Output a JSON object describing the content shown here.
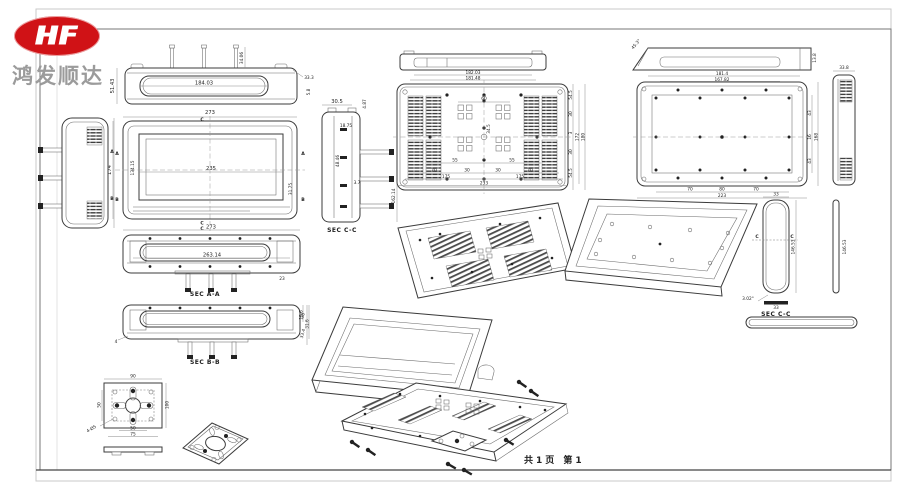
{
  "page": {
    "footer": "共1页 第1"
  },
  "logo": {
    "monogram": "HF",
    "company": "鸿发顺达",
    "oval_color": "#d01216",
    "company_color": "#9b9b9b"
  },
  "sections": {
    "aa": "SEC A-A",
    "bb": "SEC B-B",
    "cc": "SEC C-C",
    "cc_right": "SEC C-C"
  },
  "markers": {
    "a": "A",
    "b": "B",
    "c": "C"
  },
  "dims": {
    "top_view": {
      "slot": "184.03",
      "height": "51.43",
      "pin": "34.06",
      "corner": "33.3",
      "edge": "5.8"
    },
    "front_view": {
      "width": "273",
      "screen_w": "235",
      "screen_h": "134.15",
      "height": "174",
      "bezel": "31.75"
    },
    "sec_cc": {
      "depth": "30.5",
      "lip": "4.87",
      "offset": "18.75",
      "mid": "48.46",
      "rib": "3.7",
      "height": "162.14"
    },
    "rear_profile": {
      "w1": "182.03",
      "w2": "181.48"
    },
    "rear_view": {
      "vesa_w": "60",
      "vesa_h": "34.5",
      "p_l": "55",
      "p_r": "55",
      "b1": "70",
      "b2": "30",
      "b3": "30",
      "b4": "70",
      "m1": "175",
      "m2": "175",
      "total_w": "233",
      "r1": "54.5",
      "r2": "30",
      "r3": "3",
      "r4": "30",
      "r5": "54.5",
      "inner_h": "172",
      "total_h": "180"
    },
    "right_profile": {
      "w1": "181.4",
      "w2": "167.82",
      "end": "13.8",
      "angle": "45.3°"
    },
    "panel_view": {
      "b1": "70",
      "b2": "80",
      "b3": "70",
      "total_w": "223",
      "r1": "43",
      "r2": "16",
      "r3": "43",
      "total_h": "168"
    },
    "side_view": {
      "width": "33.8"
    },
    "bracket": {
      "width": "33",
      "height": "146.53",
      "angle": "3.02°",
      "base": "33"
    },
    "strip": {
      "height": "146.53"
    },
    "sec_aa": {
      "width": "273",
      "inner": "263.14",
      "tab": "23"
    },
    "sec_bb": {
      "h1": "15.6",
      "h2": "31.6",
      "foot": "4"
    },
    "plate": {
      "width": "90",
      "left": "50",
      "right": "100",
      "b1": "50",
      "b2": "75",
      "holes": "4-Ø5"
    },
    "exploded": {
      "d1": "38",
      "d2": "33.4"
    }
  }
}
